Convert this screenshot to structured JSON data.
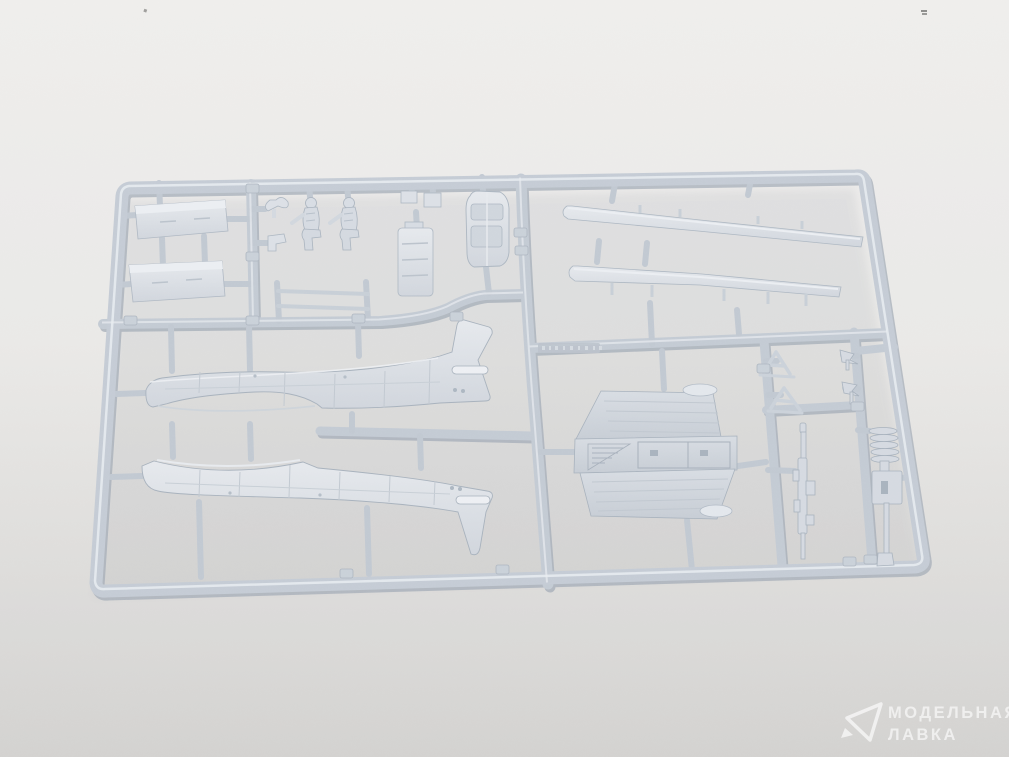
{
  "photo": {
    "subject": "injection-molded plastic model kit sprue with aircraft parts on a gray studio background"
  },
  "watermark": {
    "logo": "paper-plane-triangle-logo",
    "line1": "МОДЕЛЬНАЯ",
    "line2": "ЛАВКА"
  },
  "colors": {
    "background_top": "#f3f2f0",
    "background_bottom": "#d6d5d3",
    "plastic_base": "#c5ccd5",
    "plastic_light": "#e7eaef",
    "plastic_shadow": "#a9b2bd"
  }
}
